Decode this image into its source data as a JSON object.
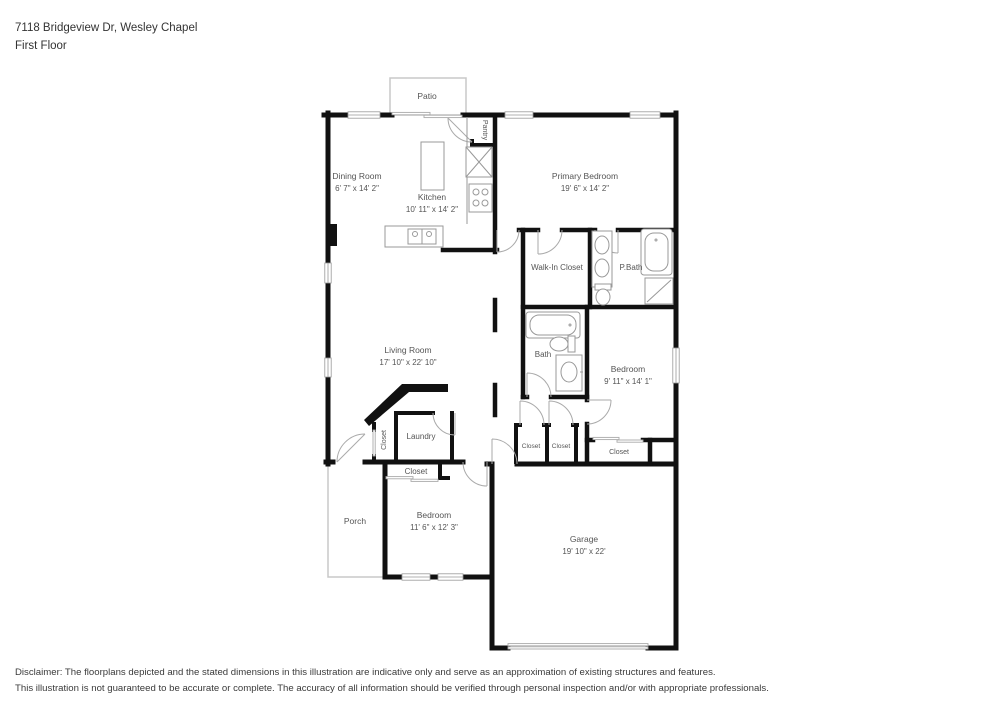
{
  "header": {
    "address": "7118 Bridgeview Dr, Wesley Chapel",
    "floor_label": "First Floor"
  },
  "rooms": {
    "patio": {
      "label": "Patio"
    },
    "pantry": {
      "label": "Pantry"
    },
    "dining_room": {
      "label": "Dining Room",
      "dims": "6' 7\" x 14' 2\""
    },
    "kitchen": {
      "label": "Kitchen",
      "dims": "10' 11\" x 14' 2\""
    },
    "primary_bedroom": {
      "label": "Primary Bedroom",
      "dims": "19' 6\" x 14' 2\""
    },
    "walk_in_closet": {
      "label": "Walk-In Closet"
    },
    "primary_bath": {
      "label": "P.Bath"
    },
    "living_room": {
      "label": "Living Room",
      "dims": "17' 10\" x 22' 10\""
    },
    "bath": {
      "label": "Bath"
    },
    "bedroom_right": {
      "label": "Bedroom",
      "dims": "9' 11\" x 14' 1\""
    },
    "laundry": {
      "label": "Laundry"
    },
    "closet_laundry": {
      "label": "Closet"
    },
    "closet_front_bedroom": {
      "label": "Closet"
    },
    "closet_hall_a": {
      "label": "Closet"
    },
    "closet_hall_b": {
      "label": "Closet"
    },
    "closet_bedroom_right": {
      "label": "Closet"
    },
    "porch": {
      "label": "Porch"
    },
    "bedroom_front": {
      "label": "Bedroom",
      "dims": "11' 6\" x 12' 3\""
    },
    "garage": {
      "label": "Garage",
      "dims": "19' 10\" x 22'"
    }
  },
  "footer": {
    "disclaimer_line1": "Disclaimer: The floorplans depicted and the stated dimensions in this illustration are indicative only and serve as an approximation of existing structures and features.",
    "disclaimer_line2": "This illustration is not guaranteed to be accurate or complete. The accuracy of all information should be verified through personal inspection and/or with appropriate professionals."
  }
}
